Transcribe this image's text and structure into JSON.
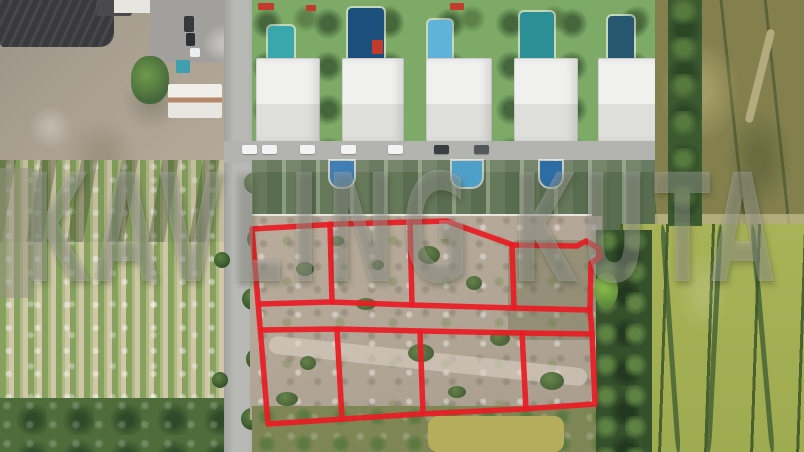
{
  "image": {
    "kind": "aerial-drone-photo",
    "subject": "land plots for sale outlined in red, bordered by villas, a road, a crop plantation and rice fields"
  },
  "watermark": {
    "text": "KAVLING KUTA",
    "opacity": "0.26"
  },
  "plot_grid": {
    "rows": 2,
    "plots_per_row": 4,
    "total_plots": 8,
    "outline_color": "#ea1c24"
  },
  "palette": {
    "plot_red": "#ea1c24",
    "parcel_dirt": "#b3a696",
    "rice_bright": "#a5b157",
    "rice_olive": "#83804e",
    "roof_green": "#62755a",
    "roof_white": "#eeeeec",
    "pool_blue": "#2d6da3",
    "road_gray": "#b8b9b5",
    "plantation_tan": "#d0c7a9",
    "tree_dark": "#35512c"
  }
}
